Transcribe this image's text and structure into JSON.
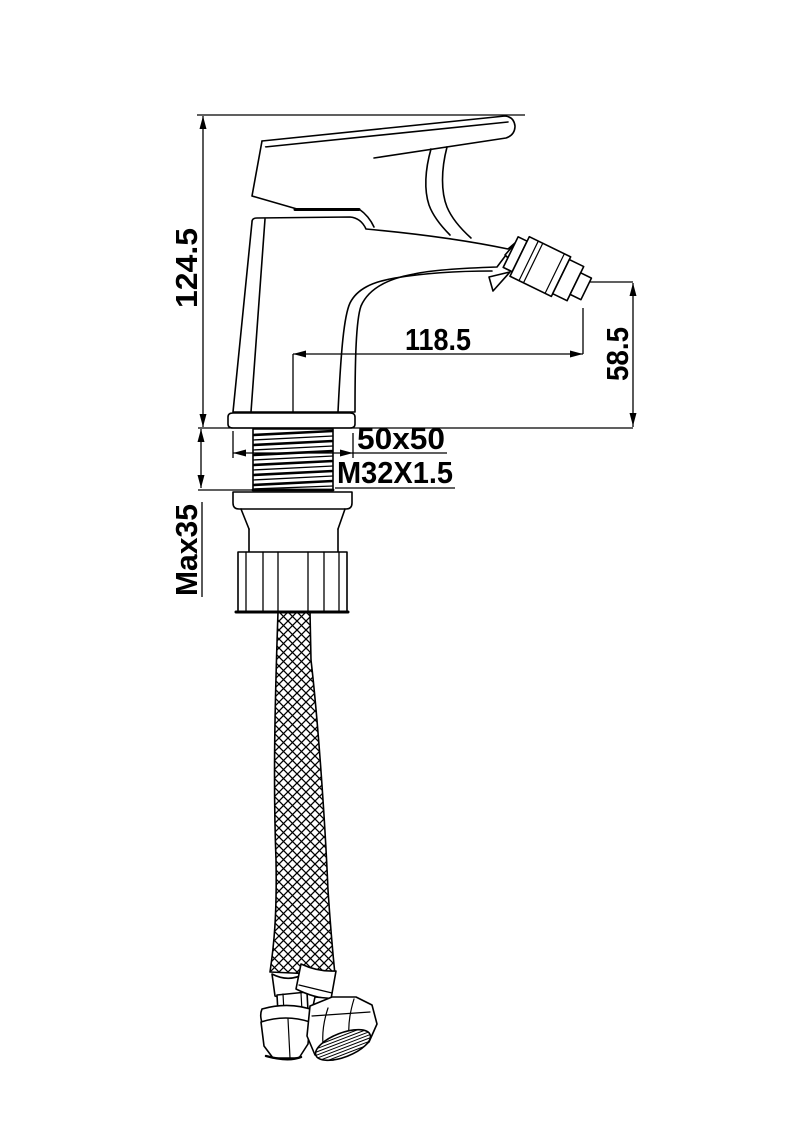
{
  "drawing": {
    "background_color": "#ffffff",
    "line_color": "#000000",
    "dimensions": {
      "overall_height": "124.5",
      "spout_reach": "118.5",
      "outlet_height": "58.5",
      "base_plate_size": "50x50",
      "mounting_thread": "M32X1.5",
      "max_deck_thickness": "Max35"
    }
  }
}
